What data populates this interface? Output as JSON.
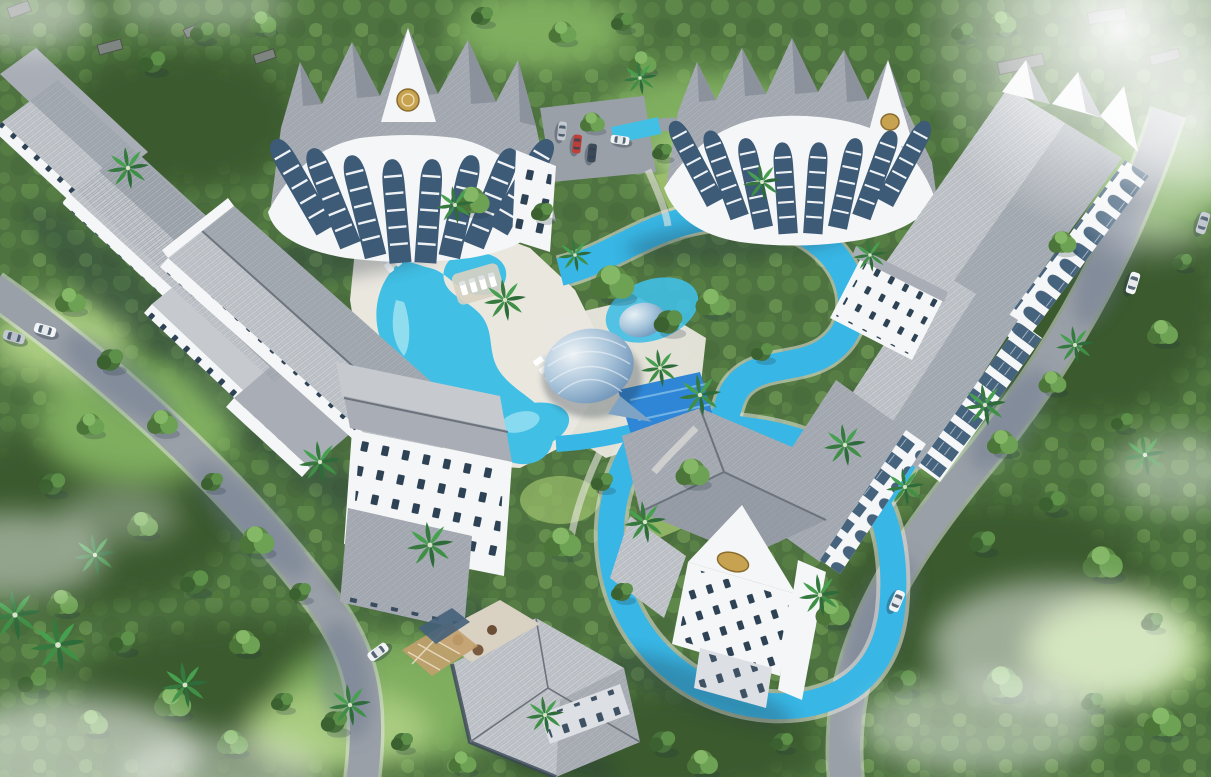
{
  "scene": {
    "description": "Aerial 3D architectural rendering of a tropical resort-style condominium complex with sawtooth-roof crescent buildings, a free-form lagoon pool, a lazy river, a shell-shaped dome pavilion and dense surrounding jungle",
    "time_of_day": "bright daylight",
    "render_style": "CGI masterplan bird's-eye view"
  },
  "palette": {
    "forest-base": "#4e7340",
    "forest-dark": "#3a5a2e",
    "forest-light": "#7fae5f",
    "forest-lighter": "#a9cc80",
    "lawn": "#9dc06c",
    "road": "#9aa0a8",
    "road-shadow": "#5f6e85",
    "deck": "#eae7df",
    "deck-shade": "#d9d2c2",
    "pool": "#41bfe4",
    "pool-light": "#a5e5f3",
    "pool-deep": "#2f86d6",
    "river": "#38b6e5",
    "roof-light": "#c6cacf",
    "roof-mid": "#a9aeb6",
    "roof-dark": "#868d97",
    "ridge": "#6c737d",
    "wall": "#f5f6f7",
    "wall-shade": "#dcdfe4",
    "glass": "#2e4255",
    "arch-glass": "#3d5a76",
    "gold": "#c7a351",
    "gold-dark": "#8a6c2e",
    "car-red": "#c23f38",
    "car-white": "#f2f4f6",
    "car-silver": "#c3c9d1",
    "car-dark": "#3c4a58",
    "mist": "#ffffff",
    "shadow": "#22303f"
  },
  "inventory": {
    "buildings": [
      {
        "name": "north-crescent-block",
        "features": "sawtooth gray roof, white arched balcony bays, gold crest on gable"
      },
      {
        "name": "northeast-crescent-block",
        "features": "sawtooth gray roof, white arched balcony bays, gold crest on gable"
      },
      {
        "name": "west-terrace-wings",
        "features": "stepped parallel wings with long gabled gray roofs and window strips"
      },
      {
        "name": "central-west-slab",
        "features": "long diagonal gabled roof with white window facade"
      },
      {
        "name": "central-south-block",
        "features": "white block facade with scattered dark windows and tiled annex roof"
      },
      {
        "name": "south-pavilion-block",
        "features": "hip roof, white gable with gold oval crest, windowed facade"
      },
      {
        "name": "east-terrace-block",
        "features": "long sloped shingle roofs with white arched gallery facing the road"
      },
      {
        "name": "clubhouse",
        "features": "hip shingle roof, dark fascia, terrace with round tables, pergola"
      }
    ],
    "amenities": [
      {
        "name": "lagoon-pool"
      },
      {
        "name": "kids-pool"
      },
      {
        "name": "lazy-river-loop"
      },
      {
        "name": "shell-dome-pavilion"
      },
      {
        "name": "small-dome-pavilion"
      },
      {
        "name": "sun-deck-with-loungers"
      },
      {
        "name": "in-pool-lounger-shelf"
      },
      {
        "name": "parking-court"
      }
    ],
    "vehicles": [
      {
        "name": "car",
        "color": "silver",
        "location": "west road, upper"
      },
      {
        "name": "car",
        "color": "white",
        "location": "west road, upper"
      },
      {
        "name": "car",
        "color": "white",
        "location": "west road, lower bend"
      },
      {
        "name": "car",
        "color": "silver",
        "location": "parking court"
      },
      {
        "name": "car",
        "color": "red",
        "location": "parking court"
      },
      {
        "name": "car",
        "color": "dark",
        "location": "parking court"
      },
      {
        "name": "car",
        "color": "white",
        "location": "parking court"
      },
      {
        "name": "car",
        "color": "white",
        "location": "east road, middle"
      },
      {
        "name": "car",
        "color": "white",
        "location": "east road, south"
      }
    ],
    "vegetation": {
      "canopy": "dense tropical forest surrounding the site",
      "palms": "coconut palms along pools, roads and courtyards"
    },
    "environment": {
      "mist": "white haze wisps over the corners and the forest",
      "village": "existing small rooftops among trees along the top edge"
    }
  }
}
